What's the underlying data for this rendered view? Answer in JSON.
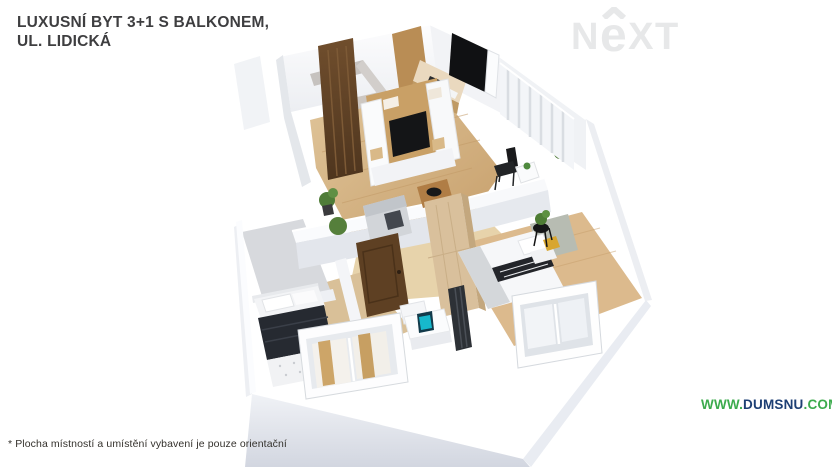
{
  "title": {
    "line1": "LUXUSNÍ BYT 3+1 S BALKONEM,",
    "line2": "UL. LIDICKÁ"
  },
  "logo": {
    "name": "NEXT",
    "n": "N",
    "e": "e",
    "xt": "XT"
  },
  "website": {
    "www": "WWW.",
    "domain": "DUMSNU",
    "tld": ".COM"
  },
  "disclaimer": "* Plocha místností a umístění vybavení je pouze orientační",
  "colors": {
    "accent_green": "#3cab4d",
    "navy": "#1d3f74",
    "title_text": "#3e3e40",
    "logo_gray": "#e7e8e9",
    "floor_wood": "#d3b184",
    "hall_wood": "#e7d3ab",
    "dark_wood": "#64452a",
    "tan_wardrobe": "#d9c09c",
    "wall_light": "#f2f3f6",
    "base_gray": "#d8dce5",
    "monitor_teal": "#17b8cc"
  }
}
